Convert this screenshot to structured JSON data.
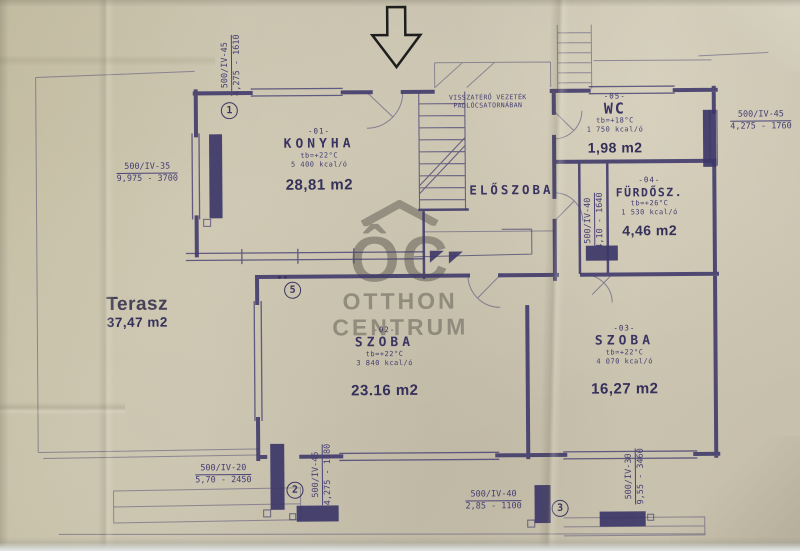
{
  "plan": {
    "watermark": {
      "logo": "ÔC",
      "line1": "OTTHON",
      "line2": "CENTRUM"
    },
    "entrance_note": {
      "line1": "VISSZATÉRŐ VEZETÉK",
      "line2": "PADLÓCSATORNÁBAN"
    },
    "rooms": {
      "konyha": {
        "code": "-01-",
        "name": "KONYHA",
        "temp": "tb=+22°C",
        "heat": "5 400 kcal/ó",
        "area": "28,81 m2"
      },
      "szoba2": {
        "code": "-02-",
        "name": "SZOBA",
        "temp": "tb=+22°C",
        "heat": "3 840 kcal/ó",
        "area": "23.16 m2"
      },
      "szoba3": {
        "code": "-03-",
        "name": "SZOBA",
        "temp": "tb=+22°C",
        "heat": "4 070 kcal/ó",
        "area": "16,27 m2"
      },
      "furdoszoba": {
        "code": "-04-",
        "name": "FÜRDŐSZ.",
        "temp": "tb=+26°C",
        "heat": "1 530 kcal/ó",
        "area": "4,46 m2"
      },
      "wc": {
        "code": "-05-",
        "name": "WC",
        "temp": "tb=+18°C",
        "heat": "1 750 kcal/ó",
        "area": "1,98 m2"
      },
      "eloszoba": {
        "name": "ELŐSZOBA"
      },
      "terasz": {
        "name": "Terasz",
        "area": "37,47 m2"
      }
    },
    "radiator_labels": {
      "d1": {
        "type": "500/IV-35",
        "size": "9,975 - 3700"
      },
      "d2": {
        "type": "500/IV-45",
        "size": "4,275 - 1610"
      },
      "d3": {
        "type": "500/IV-45",
        "size": "4,275 - 1760"
      },
      "d4": {
        "type": "500/IV-40",
        "size": "4,10 - 1640"
      },
      "d5": {
        "type": "500/IV-20",
        "size": "5,70 - 2450"
      },
      "d6": {
        "type": "500/IV-45",
        "size": "4,275 - 1680"
      },
      "d7": {
        "type": "500/IV-40",
        "size": "2,85 - 1100"
      },
      "d8": {
        "type": "500/IV-30",
        "size": "9,55 - 3460"
      }
    },
    "markers": {
      "m1": "1",
      "m2": "2",
      "m3": "3",
      "m5": "5"
    }
  },
  "colors": {
    "paper": "#c8c1ad",
    "ink": "#3d3769",
    "watermark": "#706b5f",
    "arrow": "#1e1e1e"
  }
}
